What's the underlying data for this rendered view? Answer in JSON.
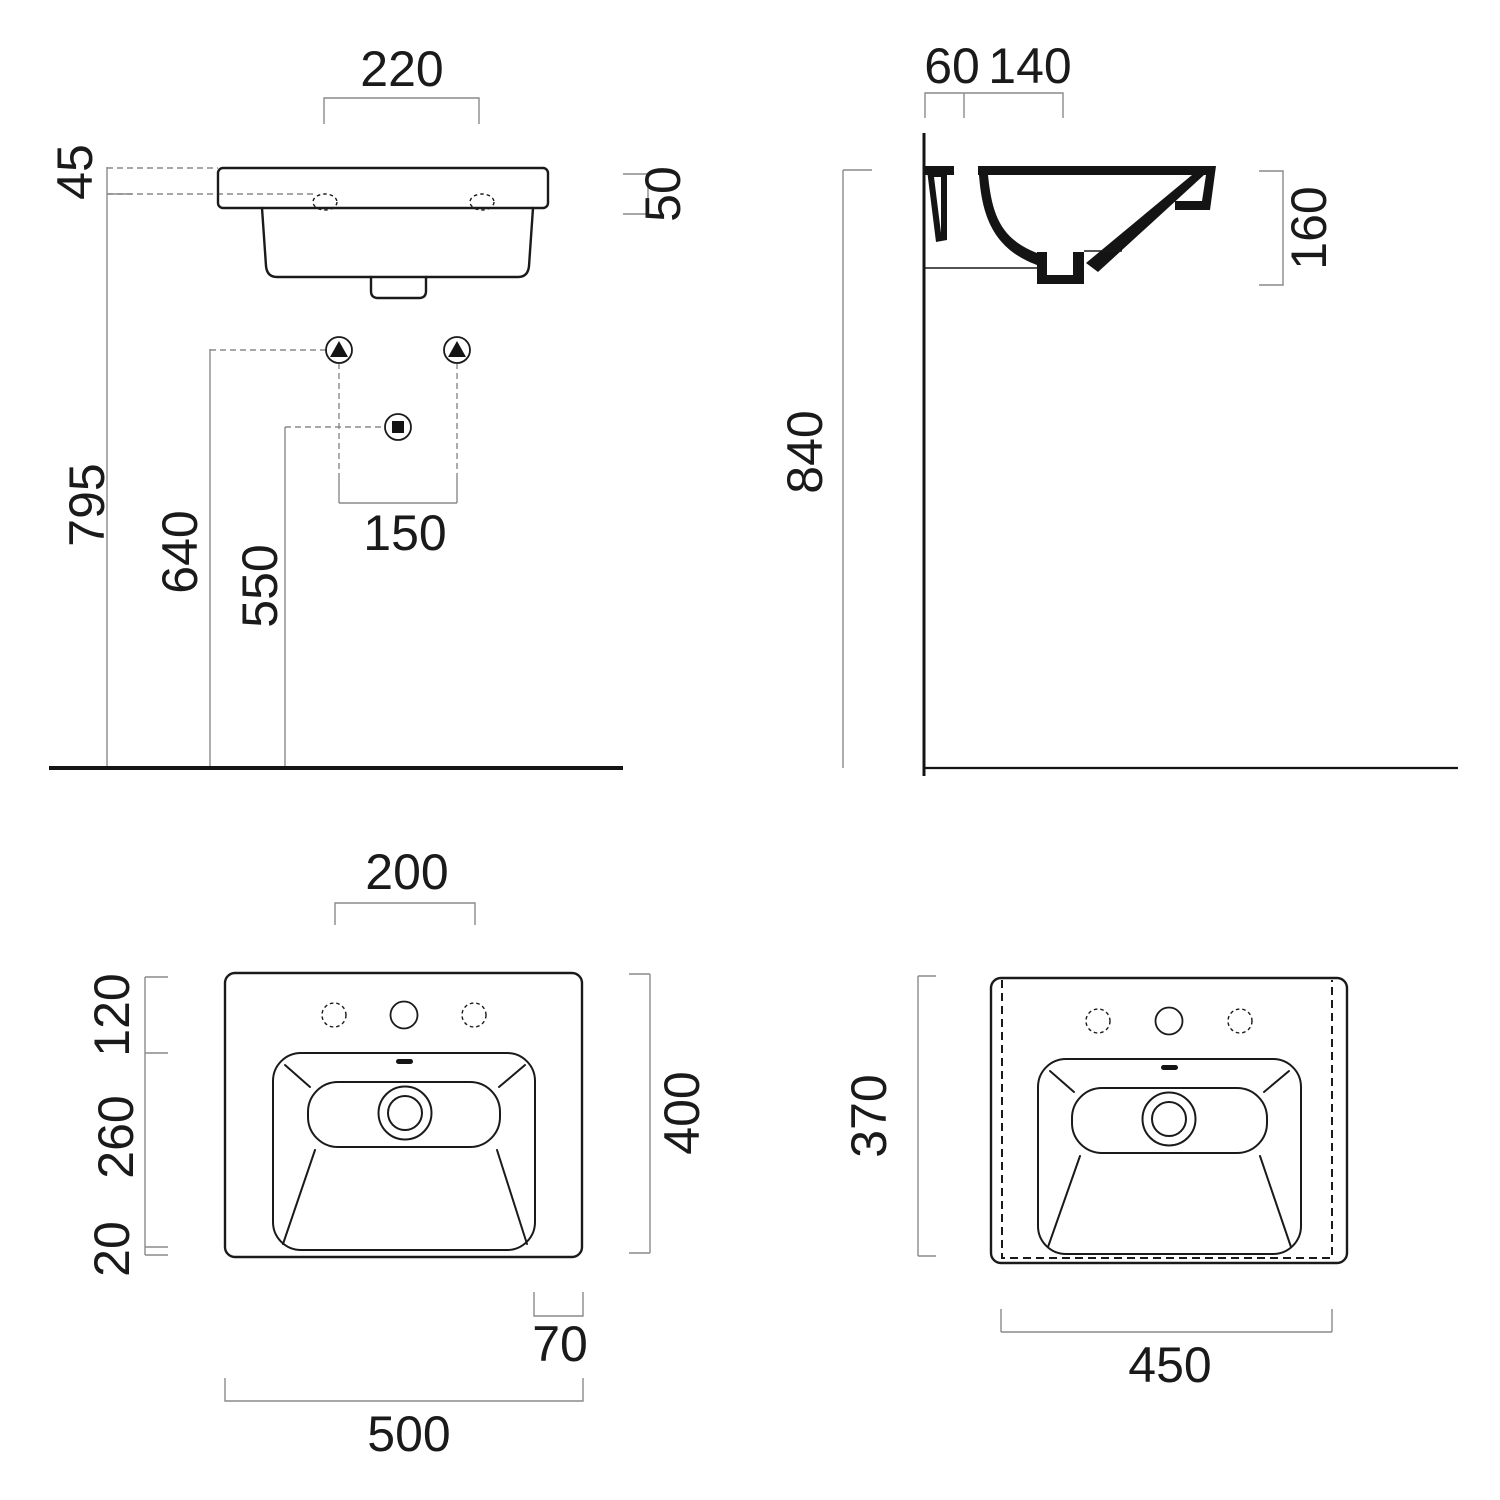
{
  "colors": {
    "line": "#1a1a1a",
    "dim_line": "#8a8a8a",
    "background": "#ffffff"
  },
  "front_view": {
    "tap_holes_width": "220",
    "rim_drop": "45",
    "rim_thickness": "50",
    "total_height": "795",
    "supply_height": "640",
    "waste_height": "550",
    "supply_spacing": "150"
  },
  "side_view": {
    "wall_gap": "60",
    "tap_offset": "140",
    "basin_depth": "160",
    "rim_floor_height": "840"
  },
  "plan_view": {
    "tap_spacing": "200",
    "back_zone": "120",
    "bowl_zone": "260",
    "front_zone": "20",
    "overall_depth": "400",
    "side_offset": "70",
    "overall_width": "500"
  },
  "underside_view": {
    "body_depth": "370",
    "body_width": "450"
  }
}
